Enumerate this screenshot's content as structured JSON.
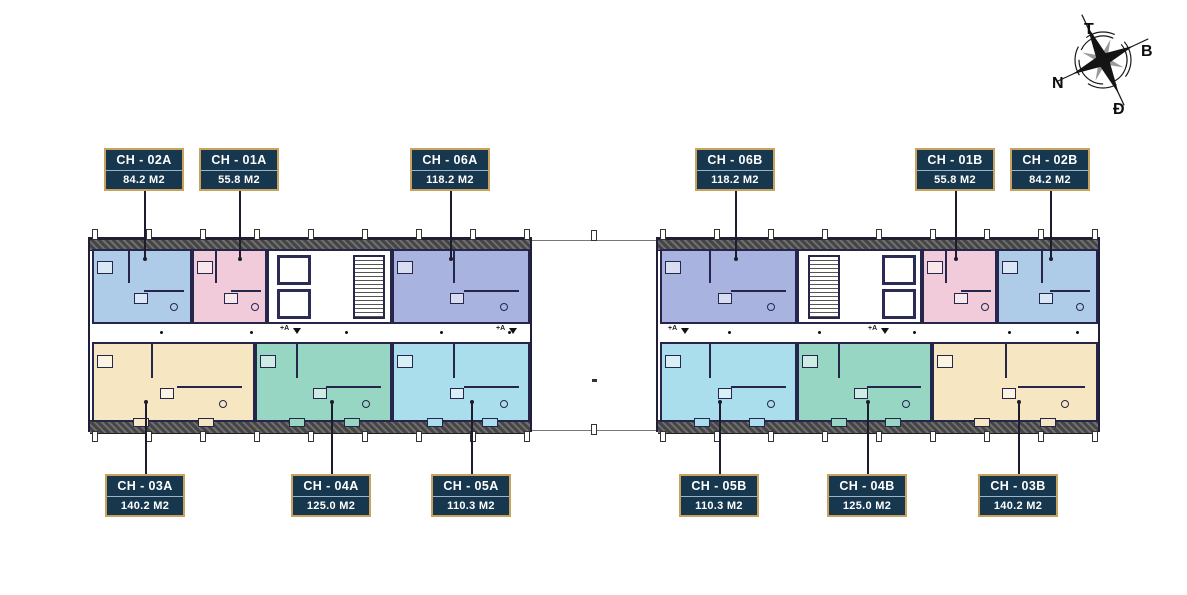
{
  "compass": {
    "top": "T",
    "right": "B",
    "left": "N",
    "bottom": "Đ"
  },
  "palette": {
    "label_bg": "#16374e",
    "label_border": "#c9a25e",
    "label_text": "#ffffff",
    "wall": "#26264c",
    "leader": "#1c1c2e",
    "unit_blue": "#aecbe8",
    "unit_pink": "#f1cbd9",
    "unit_periwinkle": "#a9b3df",
    "unit_cream": "#f7e6c2",
    "unit_teal": "#96d6c3",
    "unit_cyan": "#abdeed"
  },
  "floorplan": {
    "wings": [
      {
        "id": "left",
        "core": {
          "x": 177,
          "w": 125,
          "stairs_side": "right"
        }
      },
      {
        "id": "right",
        "core": {
          "x": 139,
          "w": 125,
          "stairs_side": "left"
        }
      }
    ],
    "annotations": [
      {
        "wing": "left",
        "text": "+A",
        "x": 190,
        "y": 86
      },
      {
        "wing": "left",
        "text": "+A",
        "x": 406,
        "y": 86
      },
      {
        "wing": "right",
        "text": "+A",
        "x": 10,
        "y": 86
      },
      {
        "wing": "right",
        "text": "+A",
        "x": 210,
        "y": 86
      }
    ]
  },
  "apartments": [
    {
      "name": "CH - 02A",
      "area": "84.2 M2",
      "color": "#aecbe8",
      "wing": "left",
      "row": "top",
      "ux": 2,
      "uw": 100,
      "label_x": 104,
      "label_y": 148
    },
    {
      "name": "CH - 01A",
      "area": "55.8 M2",
      "color": "#f1cbd9",
      "wing": "left",
      "row": "top",
      "ux": 102,
      "uw": 75,
      "label_x": 199,
      "label_y": 148
    },
    {
      "name": "CH - 06A",
      "area": "118.2 M2",
      "color": "#a9b3df",
      "wing": "left",
      "row": "top",
      "ux": 302,
      "uw": 138,
      "label_x": 410,
      "label_y": 148
    },
    {
      "name": "CH - 06B",
      "area": "118.2 M2",
      "color": "#a9b3df",
      "wing": "right",
      "row": "top",
      "ux": 2,
      "uw": 137,
      "label_x": 695,
      "label_y": 148
    },
    {
      "name": "CH - 01B",
      "area": "55.8 M2",
      "color": "#f1cbd9",
      "wing": "right",
      "row": "top",
      "ux": 264,
      "uw": 75,
      "label_x": 915,
      "label_y": 148
    },
    {
      "name": "CH - 02B",
      "area": "84.2 M2",
      "color": "#aecbe8",
      "wing": "right",
      "row": "top",
      "ux": 339,
      "uw": 101,
      "label_x": 1010,
      "label_y": 148
    },
    {
      "name": "CH - 03A",
      "area": "140.2 M2",
      "color": "#f7e6c2",
      "wing": "left",
      "row": "bottom",
      "ux": 2,
      "uw": 163,
      "label_x": 105,
      "label_y": 474
    },
    {
      "name": "CH - 04A",
      "area": "125.0 M2",
      "color": "#96d6c3",
      "wing": "left",
      "row": "bottom",
      "ux": 165,
      "uw": 137,
      "label_x": 291,
      "label_y": 474
    },
    {
      "name": "CH - 05A",
      "area": "110.3 M2",
      "color": "#abdeed",
      "wing": "left",
      "row": "bottom",
      "ux": 302,
      "uw": 138,
      "label_x": 431,
      "label_y": 474
    },
    {
      "name": "CH - 05B",
      "area": "110.3 M2",
      "color": "#abdeed",
      "wing": "right",
      "row": "bottom",
      "ux": 2,
      "uw": 137,
      "label_x": 679,
      "label_y": 474
    },
    {
      "name": "CH - 04B",
      "area": "125.0 M2",
      "color": "#96d6c3",
      "wing": "right",
      "row": "bottom",
      "ux": 139,
      "uw": 135,
      "label_x": 827,
      "label_y": 474
    },
    {
      "name": "CH - 03B",
      "area": "140.2 M2",
      "color": "#f7e6c2",
      "wing": "right",
      "row": "bottom",
      "ux": 274,
      "uw": 166,
      "label_x": 978,
      "label_y": 474
    }
  ]
}
